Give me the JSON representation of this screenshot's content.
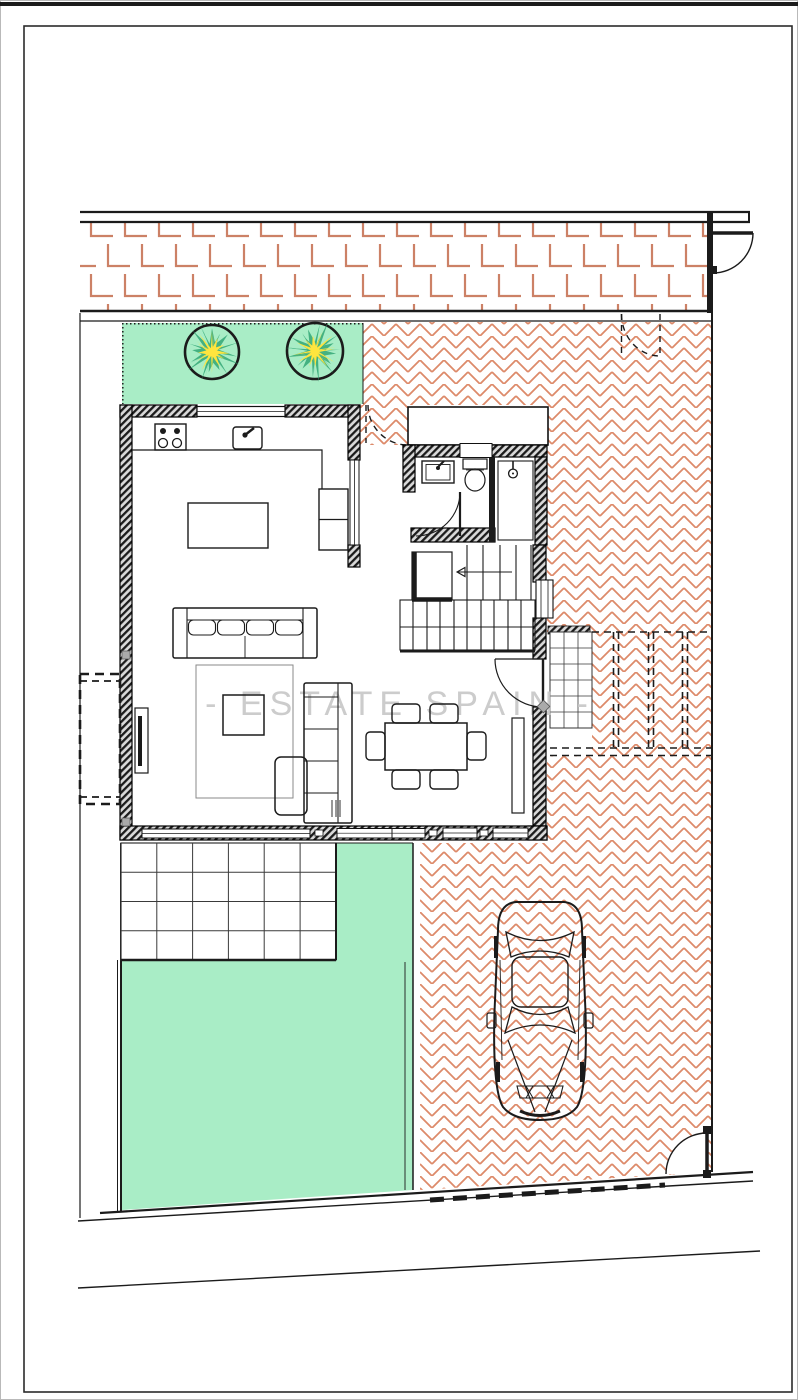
{
  "page": {
    "width": 798,
    "height": 1400,
    "background": "#ffffff"
  },
  "watermark": {
    "text": "- ESTATE SPAIN -",
    "color": "#c7c7c7"
  },
  "colors": {
    "ink": "#1b1b1b",
    "frame": "#2b2b2b",
    "grass": "#a9edc6",
    "hatch": "#dd8a6a",
    "brickline": "#cc8166",
    "wallbg": "#d9d9d9",
    "treegreen": "#35a878",
    "treeyellow": "#ffe53e",
    "watermark": "#c7c7c7",
    "marker": "#aaaaaa"
  },
  "plan": {
    "type": "ground-floor-site-plan",
    "features": [
      "street-pavement-brick-band",
      "pedestrian-gate-north-east",
      "dashed-garden-gate-north",
      "front-garden-lawn-with-two-trees",
      "herringbone-paved-driveway",
      "entry-porch",
      "kitchen-with-island",
      "living-dining-room",
      "bathroom-with-shower",
      "staircase",
      "east-tile-path",
      "pergola-carport-dashed",
      "parked-car-top-view",
      "terrace-tile-grid",
      "back-lawn",
      "planter-box-west",
      "driveway-gate-south-east",
      "plot-boundary-walls"
    ],
    "counts": {
      "trees": 2,
      "dining_chairs": 6,
      "sofas": 2,
      "parked_cars": 1
    }
  }
}
